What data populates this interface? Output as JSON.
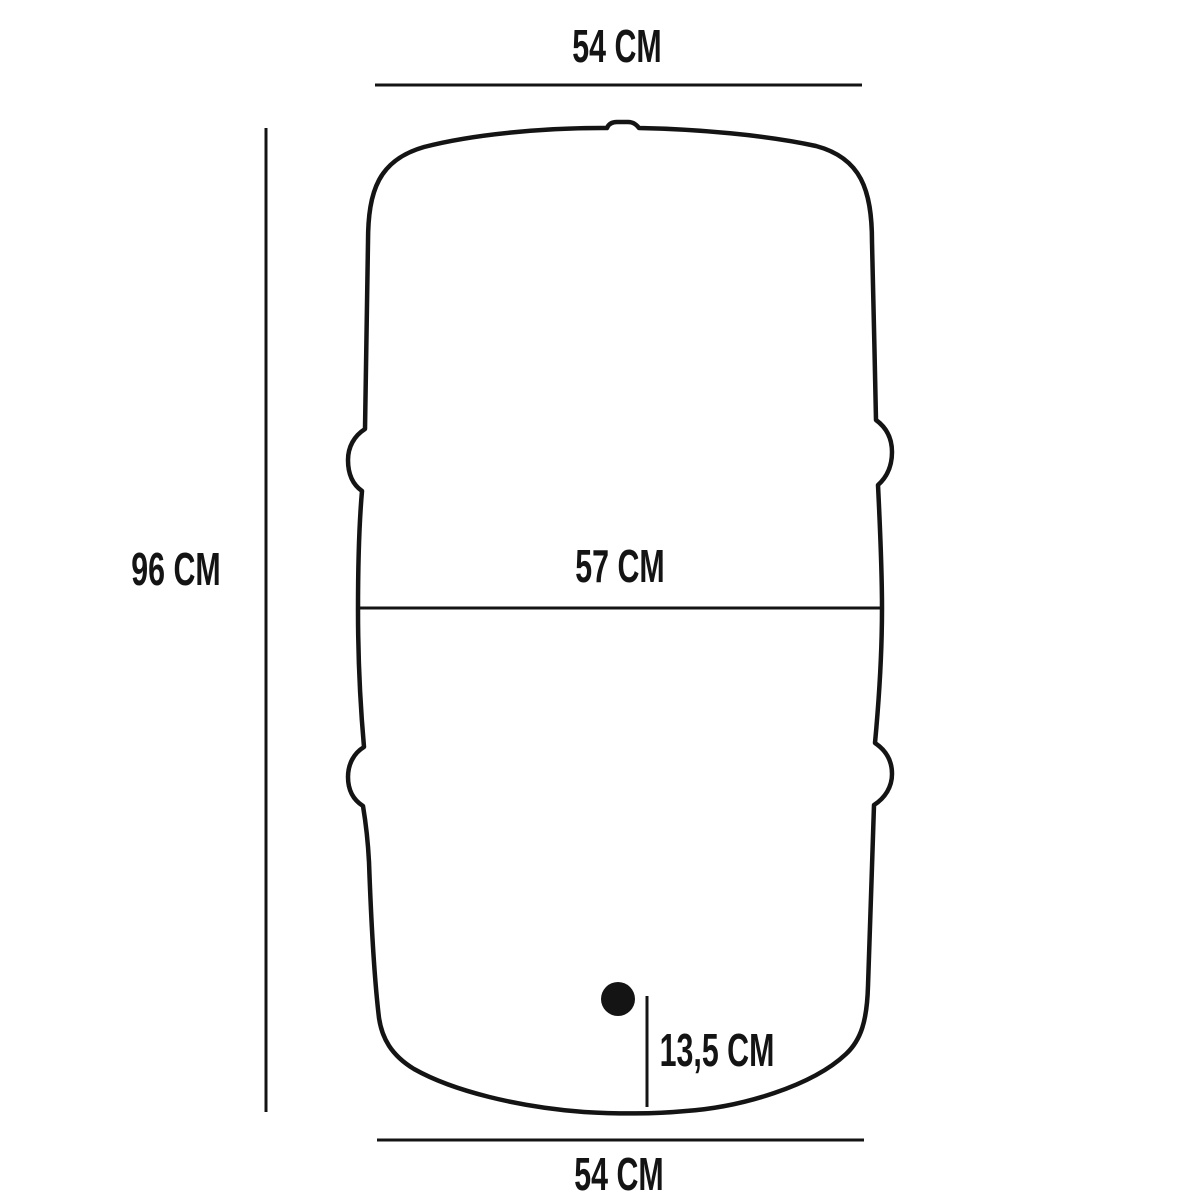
{
  "labels": {
    "top_width": "54 CM",
    "height": "96 CM",
    "middle_width": "57 CM",
    "outlet_offset": "13,5 CM",
    "bottom_width": "54 CM"
  },
  "colors": {
    "line": "#141414",
    "text": "#141414",
    "background": "#ffffff"
  }
}
